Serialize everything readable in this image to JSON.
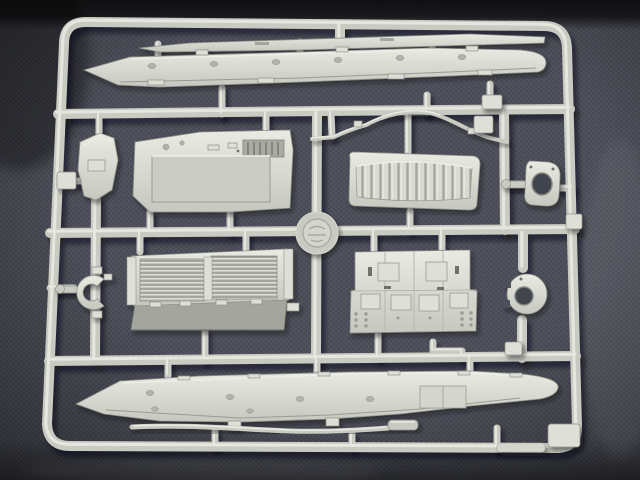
{
  "image": {
    "kind": "photograph",
    "subject": "light grey injection-molded plastic model kit sprue (parts tree) of armored vehicle parts",
    "background": "dark blue-grey woven denim-like fabric with a near-black band along the top edge and shadow below the sprue"
  },
  "colors": {
    "fabric": "#4d505a",
    "fabric-light": "#5c5f69",
    "fabric-dark": "#3a3d45",
    "top-band": "#101012",
    "plastic": "#c9cbc3",
    "plastic-hi": "#e9ebe3",
    "plastic-bright": "#dee0d8",
    "plastic-mid": "#b2b4ac",
    "plastic-dark": "#8f918a",
    "detail-dark": "#6e706a",
    "shadow": "rgba(12,14,18,0.45)"
  },
  "sprue": {
    "frame": "rounded-rectangle outer frame with three horizontal runners and multiple vertical runners and gates",
    "parts": [
      {
        "name": "upper-side-skirt-strip",
        "description": "long thin tapered strip along the top, above the upper hull side"
      },
      {
        "name": "upper-hull-side-panel",
        "description": "long hull side piece, pointed at left, rounded nose at right, rivet detail"
      },
      {
        "name": "glacis-plate",
        "description": "small curved plate on the left, middle band"
      },
      {
        "name": "engine-deck-panel",
        "description": "large deck panel with recessed rectangle and louver block, upper middle"
      },
      {
        "name": "ribbed-rear-panel",
        "description": "rounded rectangular panel with vertical ribs, upper right of middle"
      },
      {
        "name": "curved-grab-rail",
        "description": "thin curved rod / handrail between the runners"
      },
      {
        "name": "turret-ring-mount",
        "description": "rounded plate with large hole and side arm, right middle band"
      },
      {
        "name": "c-shaped-bracket",
        "description": "horseshoe-shaped bracket with side arm, lower left"
      },
      {
        "name": "louvered-grille-panel",
        "description": "double louvered engine grille with darker angled skirt below, lower middle-left"
      },
      {
        "name": "hatch-roof-panel",
        "description": "stepped flat panel with six raised square hatches and bolt rows, lower middle-right"
      },
      {
        "name": "round-hatch-ring",
        "description": "disc with central hole and notched left edge, lower right"
      },
      {
        "name": "lower-hull-side-panel",
        "description": "second long hull side piece, pointed at left, across the bottom"
      },
      {
        "name": "towing-rod",
        "description": "long thin rod with stepped end, along the bottom runner"
      },
      {
        "name": "sprue-logo-medallion",
        "description": "embossed circular maker medallion at the central runner crossing"
      },
      {
        "name": "molding-tabs",
        "description": "small rectangular gate tabs on the rails and a corner plate at bottom right"
      }
    ]
  }
}
